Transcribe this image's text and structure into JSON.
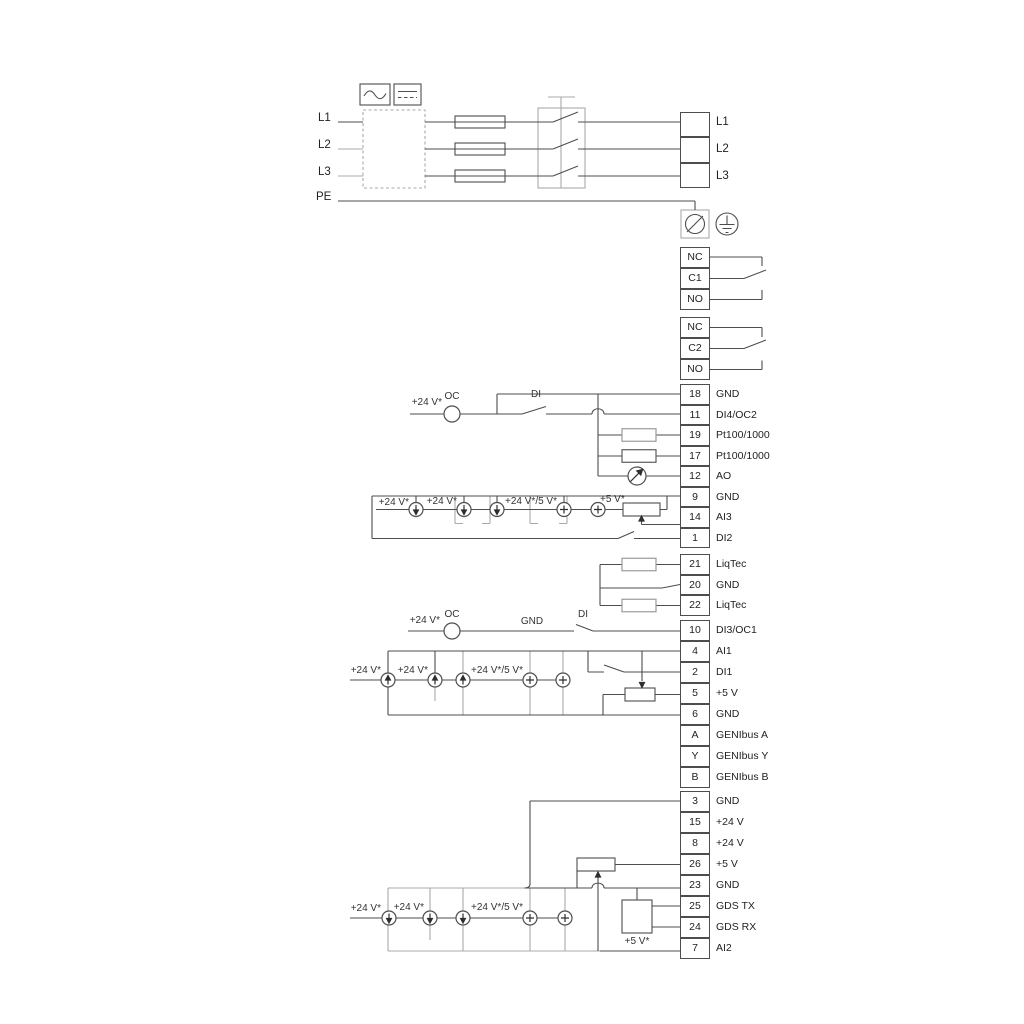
{
  "diagram": {
    "power": {
      "input_labels": [
        "L1",
        "L2",
        "L3",
        "PE"
      ],
      "output_labels": [
        "L1",
        "L2",
        "L3"
      ]
    },
    "relay1": {
      "nc": "NC",
      "c": "C1",
      "no": "NO"
    },
    "relay2": {
      "nc": "NC",
      "c": "C2",
      "no": "NO"
    },
    "strip_a": [
      {
        "id": "18",
        "label": "GND"
      },
      {
        "id": "11",
        "label": "DI4/OC2"
      },
      {
        "id": "19",
        "label": "Pt100/1000"
      },
      {
        "id": "17",
        "label": "Pt100/1000"
      },
      {
        "id": "12",
        "label": "AO"
      },
      {
        "id": "9",
        "label": "GND"
      },
      {
        "id": "14",
        "label": "AI3"
      },
      {
        "id": "1",
        "label": "DI2"
      }
    ],
    "strip_b": [
      {
        "id": "21",
        "label": "LiqTec"
      },
      {
        "id": "20",
        "label": "GND"
      },
      {
        "id": "22",
        "label": "LiqTec"
      }
    ],
    "strip_c": [
      {
        "id": "10",
        "label": "DI3/OC1"
      }
    ],
    "strip_d": [
      {
        "id": "4",
        "label": "AI1"
      },
      {
        "id": "2",
        "label": "DI1"
      },
      {
        "id": "5",
        "label": "+5 V"
      },
      {
        "id": "6",
        "label": "GND"
      },
      {
        "id": "A",
        "label": "GENIbus A"
      },
      {
        "id": "Y",
        "label": "GENIbus Y"
      },
      {
        "id": "B",
        "label": "GENIbus B"
      }
    ],
    "strip_e": [
      {
        "id": "3",
        "label": "GND"
      },
      {
        "id": "15",
        "label": "+24 V"
      },
      {
        "id": "8",
        "label": "+24 V"
      },
      {
        "id": "26",
        "label": "+5 V"
      },
      {
        "id": "23",
        "label": "GND"
      },
      {
        "id": "25",
        "label": "GDS TX"
      },
      {
        "id": "24",
        "label": "GDS RX"
      },
      {
        "id": "7",
        "label": "AI2"
      }
    ],
    "circuit1": {
      "v24": "+24 V*",
      "oc": "OC",
      "di": "DI"
    },
    "row1": {
      "v24a": "+24 V*",
      "v24b": "+24 V*",
      "v245": "+24 V*/5 V*",
      "v5": "+5 V*"
    },
    "circuit2": {
      "v24": "+24 V*",
      "oc": "OC",
      "gnd": "GND",
      "di": "DI"
    },
    "row2": {
      "v24a": "+24 V*",
      "v24b": "+24 V*",
      "v245": "+24 V*/5 V*"
    },
    "row3": {
      "v24a": "+24 V*",
      "v24b": "+24 V*",
      "v245": "+24 V*/5 V*",
      "v5": "+5 V*"
    },
    "colors": {
      "line": "#4d4d4d",
      "gray": "#aaaaaa",
      "accent_bg": "#ffffff"
    }
  }
}
